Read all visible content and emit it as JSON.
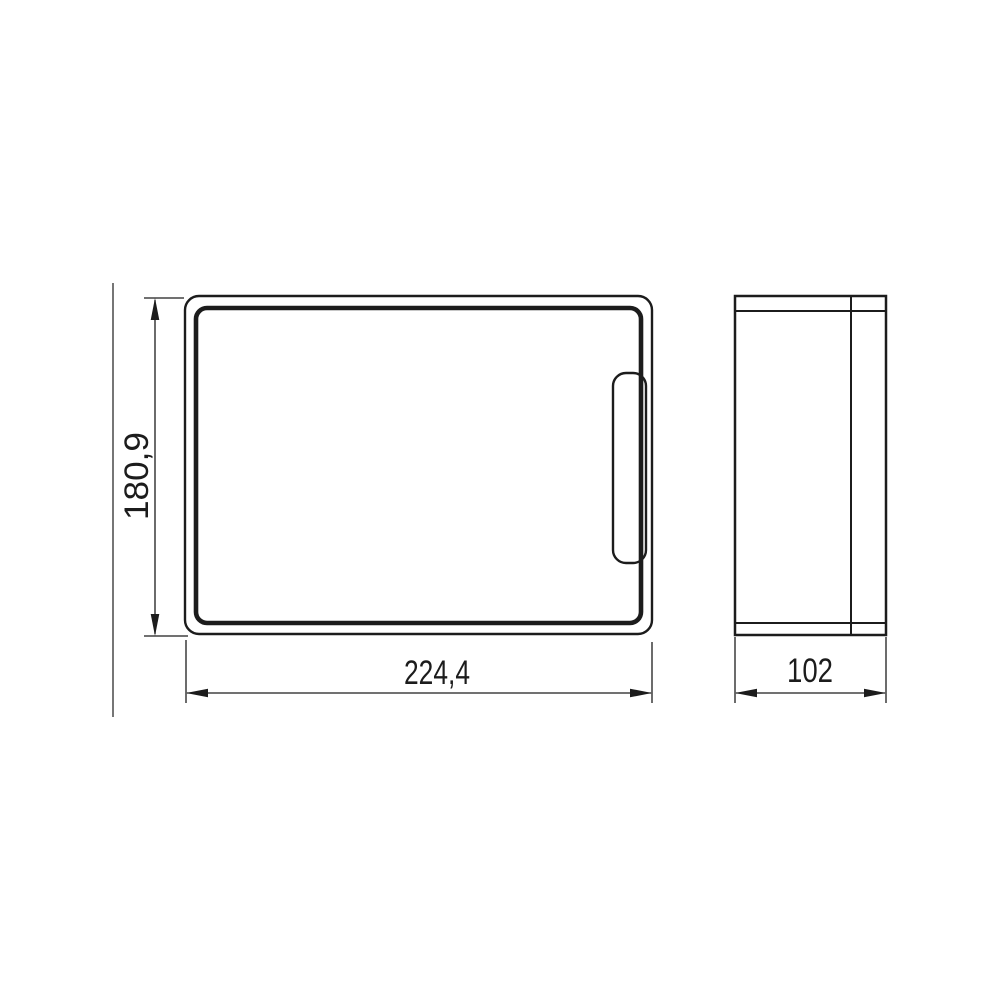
{
  "colors": {
    "line": "#1c1c1c",
    "background": "#ffffff"
  },
  "views": {
    "front": {
      "width_label": "224,4",
      "height_label": "180,9"
    },
    "side": {
      "depth_label": "102"
    }
  }
}
